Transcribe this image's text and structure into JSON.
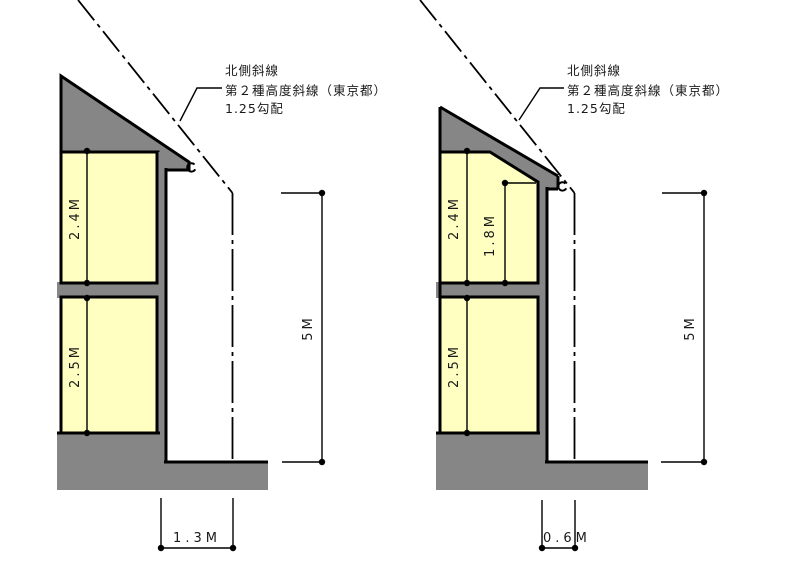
{
  "colors": {
    "building_gray": "#868686",
    "room_yellow": "#ffffc2",
    "line_black": "#000000",
    "background": "#ffffff"
  },
  "annotation": {
    "line1": "北側斜線",
    "line2": "第２種高度斜線（東京都）",
    "line3": "1.25勾配"
  },
  "left_figure": {
    "upper_room_height": "2.4M",
    "lower_room_height": "2.5M",
    "slant_start_height": "5M",
    "boundary_distance": "1.3M"
  },
  "right_figure": {
    "upper_room_height": "2.4M",
    "eave_wall_height": "1.8M",
    "lower_room_height": "2.5M",
    "slant_start_height": "5M",
    "boundary_distance": "0.6M"
  }
}
